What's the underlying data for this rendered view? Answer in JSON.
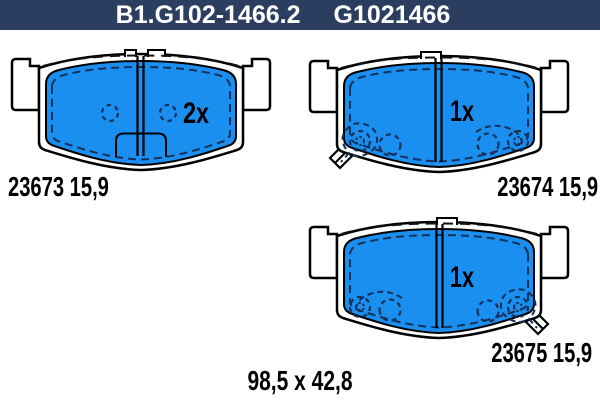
{
  "header": {
    "part_number": "B1.G102-1466.2",
    "reference": "G1021466"
  },
  "pads": [
    {
      "view": "backing-plate-back-view",
      "label": "23673 15,9",
      "quantity": "2x"
    },
    {
      "view": "pad-front-view-upper",
      "label": "23674 15,9",
      "quantity": "1x"
    },
    {
      "view": "pad-front-view-lower",
      "label": "23675 15,9",
      "quantity": "1x"
    }
  ],
  "dimensions_label": "98,5 x 42,8",
  "colors": {
    "header_bg": "#2c3e60",
    "header_text": "#ffffff",
    "pad_fill": "#1a8fef",
    "outline": "#000000",
    "dash_line": "#14315a",
    "background": "#ffffff"
  }
}
